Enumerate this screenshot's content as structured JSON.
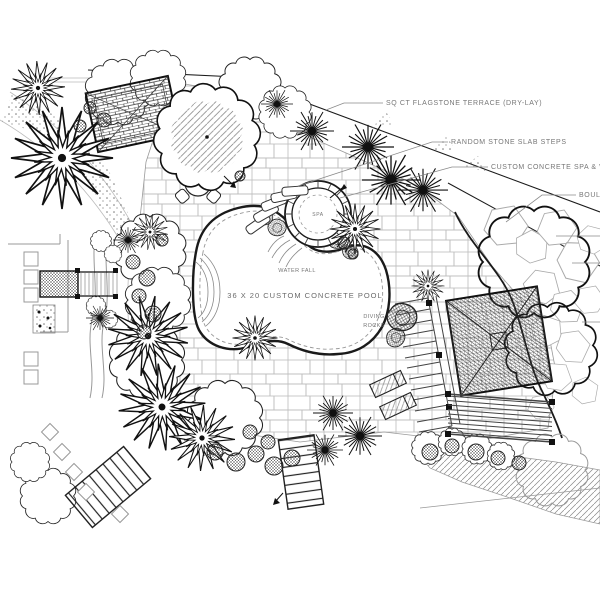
{
  "annotations": {
    "flagstone": "SQ CT FLAGSTONE TERRACE (DRY-LAY)",
    "slab_steps": "RANDOM STONE SLAB STEPS",
    "spa_callout": "CUSTOM CONCRETE SPA & WAT",
    "boulders_callout": "BOUL",
    "spa": "SPA",
    "waterfall": "WATER FALL",
    "pool": "36 X 20 CUSTOM CONCRETE POOL",
    "diving_rocks_line1": "DIVING",
    "diving_rocks_line2": "ROCKS"
  },
  "colors": {
    "ink": "#1a1a1a",
    "light_ink": "#8a8a8a",
    "paper": "#ffffff"
  }
}
